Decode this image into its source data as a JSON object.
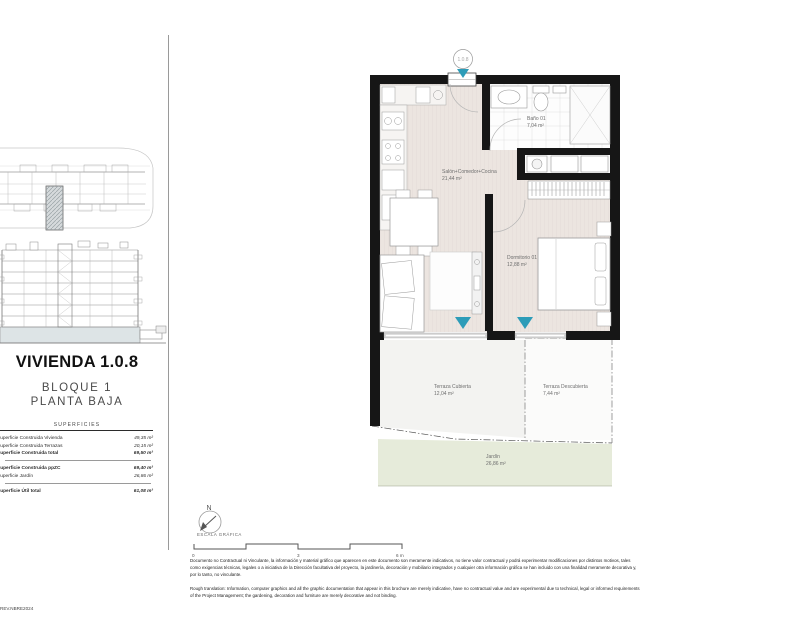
{
  "title_block": {
    "title": "VIVIENDA 1.0.8",
    "subtitle_line1": "BLOQUE 1",
    "subtitle_line2": "PLANTA BAJA",
    "surfaces_header": "SUPERFICIES",
    "rows": [
      {
        "label": "Superficie Construida Vivienda",
        "value": "49,35 m²"
      },
      {
        "label": "Superficie Construida Terrazas",
        "value": "20,15 m²"
      },
      {
        "label": "Superficie Construida total",
        "value": "69,50 m²"
      },
      {
        "label": "Superficie Construida ppZC",
        "value": "69,40 m²"
      },
      {
        "label": "Superficie Jardín",
        "value": "26,86 m²"
      },
      {
        "label": "Superficie Útil total",
        "value": "61,08 m²"
      }
    ]
  },
  "plan": {
    "unit_marker": "1.0.8",
    "rooms": [
      {
        "name": "Salón+Comedor+Cocina",
        "area": "21,44 m²"
      },
      {
        "name": "Baño 01",
        "area": "7,04 m²"
      },
      {
        "name": "Dormitorio 01",
        "area": "12,88 m²"
      },
      {
        "name": "Terraza Cubierta",
        "area": "12,04 m²"
      },
      {
        "name": "Terraza Descubierta",
        "area": "7,44 m²"
      },
      {
        "name": "Jardín",
        "area": "26,86 m²"
      }
    ]
  },
  "scale": {
    "north_label": "N",
    "label": "ESCALA GRÁFICA",
    "ticks": [
      "0",
      "3",
      "6 m"
    ]
  },
  "footer": {
    "revision": "REV.NBRE2024",
    "disclaimer_es": "Documento no Contractual ni Vinculante, la información y material gráfico que aparecen en este documento son meramente indicativos, no tiene valor contractual y podrá experimentar modificaciones por distintos motivos, tales como exigencias técnicas, legales o a iniciativa de la Dirección facultativa del proyecto, la jardinería, decoración y mobiliario integrados y cualquier otra información gráfica se han incluido con una finalidad meramente decorativa y, por lo tanto, no vinculante.",
    "disclaimer_en": "Rough translation: Information, computer graphics and all the graphic documentation that appear in this brochure are merely indicative, have no contractual value and are experimental due to technical, legal or informed requirements of the Project Management; the gardening, decoration and furniture are merely decorative and not binding."
  },
  "colors": {
    "wall": "#161616",
    "floor_beige": "#ece5e0",
    "garden_green": "#e6ebda",
    "accent_teal": "#2d9cb8",
    "ground_band": "#dde4e6"
  }
}
